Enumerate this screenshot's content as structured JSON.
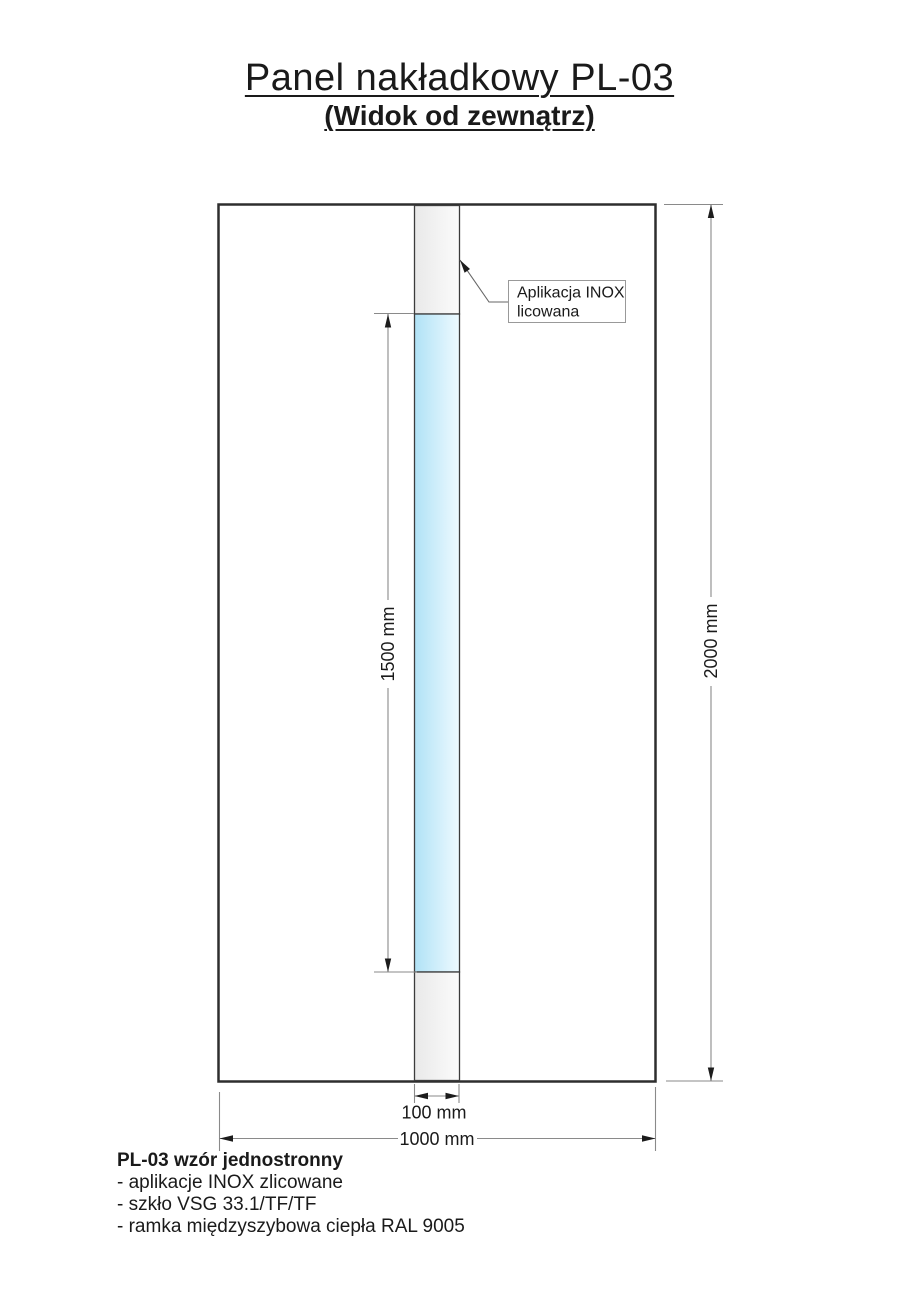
{
  "title": "Panel nakładkowy PL-03",
  "subtitle": "(Widok od zewnątrz)",
  "drawing": {
    "callout": {
      "line1": "Aplikacja INOX",
      "line2": "licowana"
    },
    "dimensions": {
      "strip_height": "1500 mm",
      "panel_height": "2000 mm",
      "strip_width": "100 mm",
      "panel_width": "1000 mm"
    },
    "colors": {
      "outline": "#2e2e2e",
      "strip_border": "#3c3c3c",
      "dimension_line": "#8a8a8a",
      "arrow": "#1c1c1c",
      "inox_gradient_start": "#e9e9e9",
      "inox_gradient_end": "#fbfbfb",
      "glass_gradient_start": "#b0e2f6",
      "glass_gradient_end": "#eefaff",
      "callout_border": "#999999"
    }
  },
  "notes": {
    "heading": "PL-03 wzór jednostronny",
    "items": [
      "- aplikacje INOX zlicowane",
      "- szkło VSG 33.1/TF/TF",
      "- ramka międzyszybowa ciepła RAL 9005"
    ]
  }
}
